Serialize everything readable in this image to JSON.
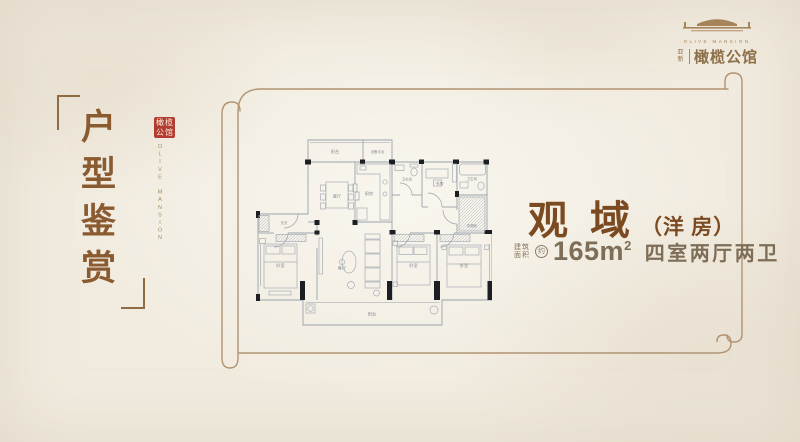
{
  "brand": {
    "en_name": "OLIVE MANSION",
    "cn_prefix": "亚新",
    "cn_name": "橄榄公馆"
  },
  "side": {
    "title": "户型鉴赏",
    "seal_text": "橄榄公馆",
    "en_vertical": "OLIVE MANSION"
  },
  "info": {
    "title": "观 域",
    "title_suffix": "（洋 房）",
    "area_prefix_line1": "建筑",
    "area_prefix_line2": "面积",
    "area_approx": "约",
    "area_value": "165m",
    "area_unit_sup": "2",
    "rooms_text": "四室两厅两卫"
  },
  "plan": {
    "rooms": {
      "balcony_top": "阳台",
      "equipment_platform": "设备平台",
      "dining": "餐厅",
      "kitchen": "厨房",
      "bath_top": "卫生间",
      "study": "书房",
      "bath_right": "卫生间",
      "cloakroom": "衣帽间",
      "entry": "玄关",
      "bedroom_left": "卧室",
      "living": "客厅",
      "bedroom_mid": "卧室",
      "bedroom_right": "卧室",
      "balcony_bottom": "阳台"
    }
  },
  "colors": {
    "background": "#f1ebdf",
    "accent_brown": "#7b4a21",
    "title_brown": "#8a5a31",
    "seal_red": "#b23c31",
    "scroll_line": "#b29372",
    "wall_black": "#1b1e23",
    "plan_line": "#9aa2ac"
  }
}
